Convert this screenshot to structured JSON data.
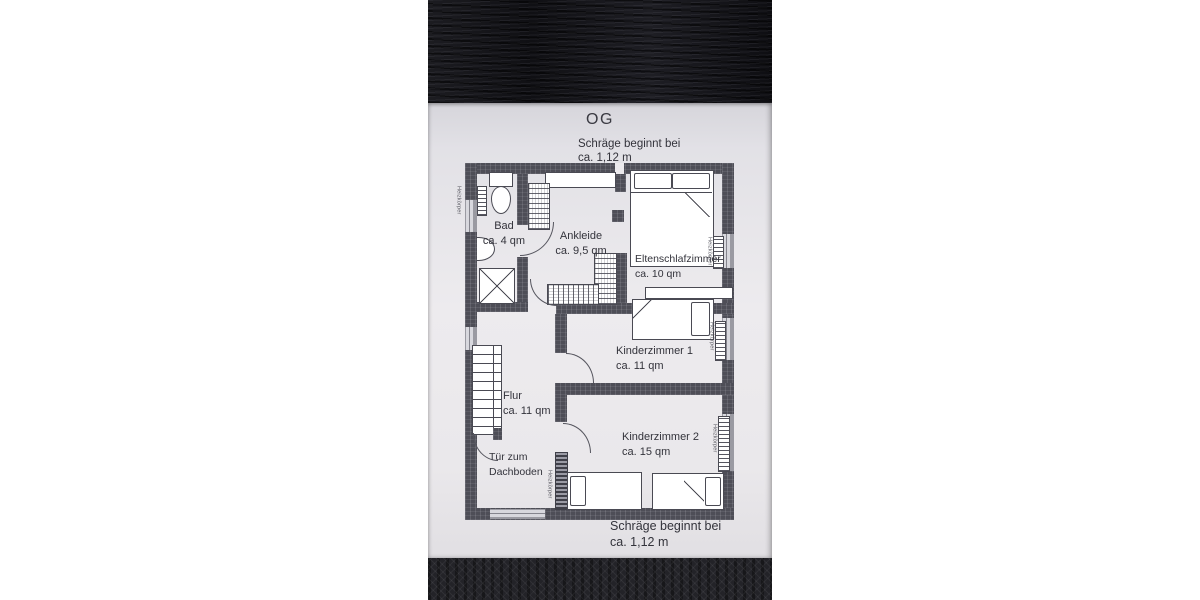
{
  "title": "OG",
  "notes": {
    "top": {
      "line1": "Schräge beginnt bei",
      "line2": "ca. 1,12 m"
    },
    "bottom": {
      "line1": "Schräge beginnt bei",
      "line2": "ca. 1,12 m"
    }
  },
  "rooms": [
    {
      "name": "Bad",
      "area": "ca. 4 qm"
    },
    {
      "name": "Ankleide",
      "area": "ca. 9,5 qm"
    },
    {
      "name": "Eltenschlafzimmer",
      "area": "ca. 10 qm"
    },
    {
      "name": "Kinderzimmer 1",
      "area": "ca. 11 qm"
    },
    {
      "name": "Flur",
      "area": "ca. 11 qm"
    },
    {
      "name": "Kinderzimmer 2",
      "area": "ca. 15 qm"
    }
  ],
  "attic_door": {
    "line1": "Tür zum",
    "line2": "Dachboden"
  },
  "radiator_label": "Heizkörper",
  "palette": {
    "paper": "#ebe9ec",
    "wall": "#4e4e57",
    "wood": "#141417",
    "fabric": "#232328",
    "ink": "#33333b"
  }
}
